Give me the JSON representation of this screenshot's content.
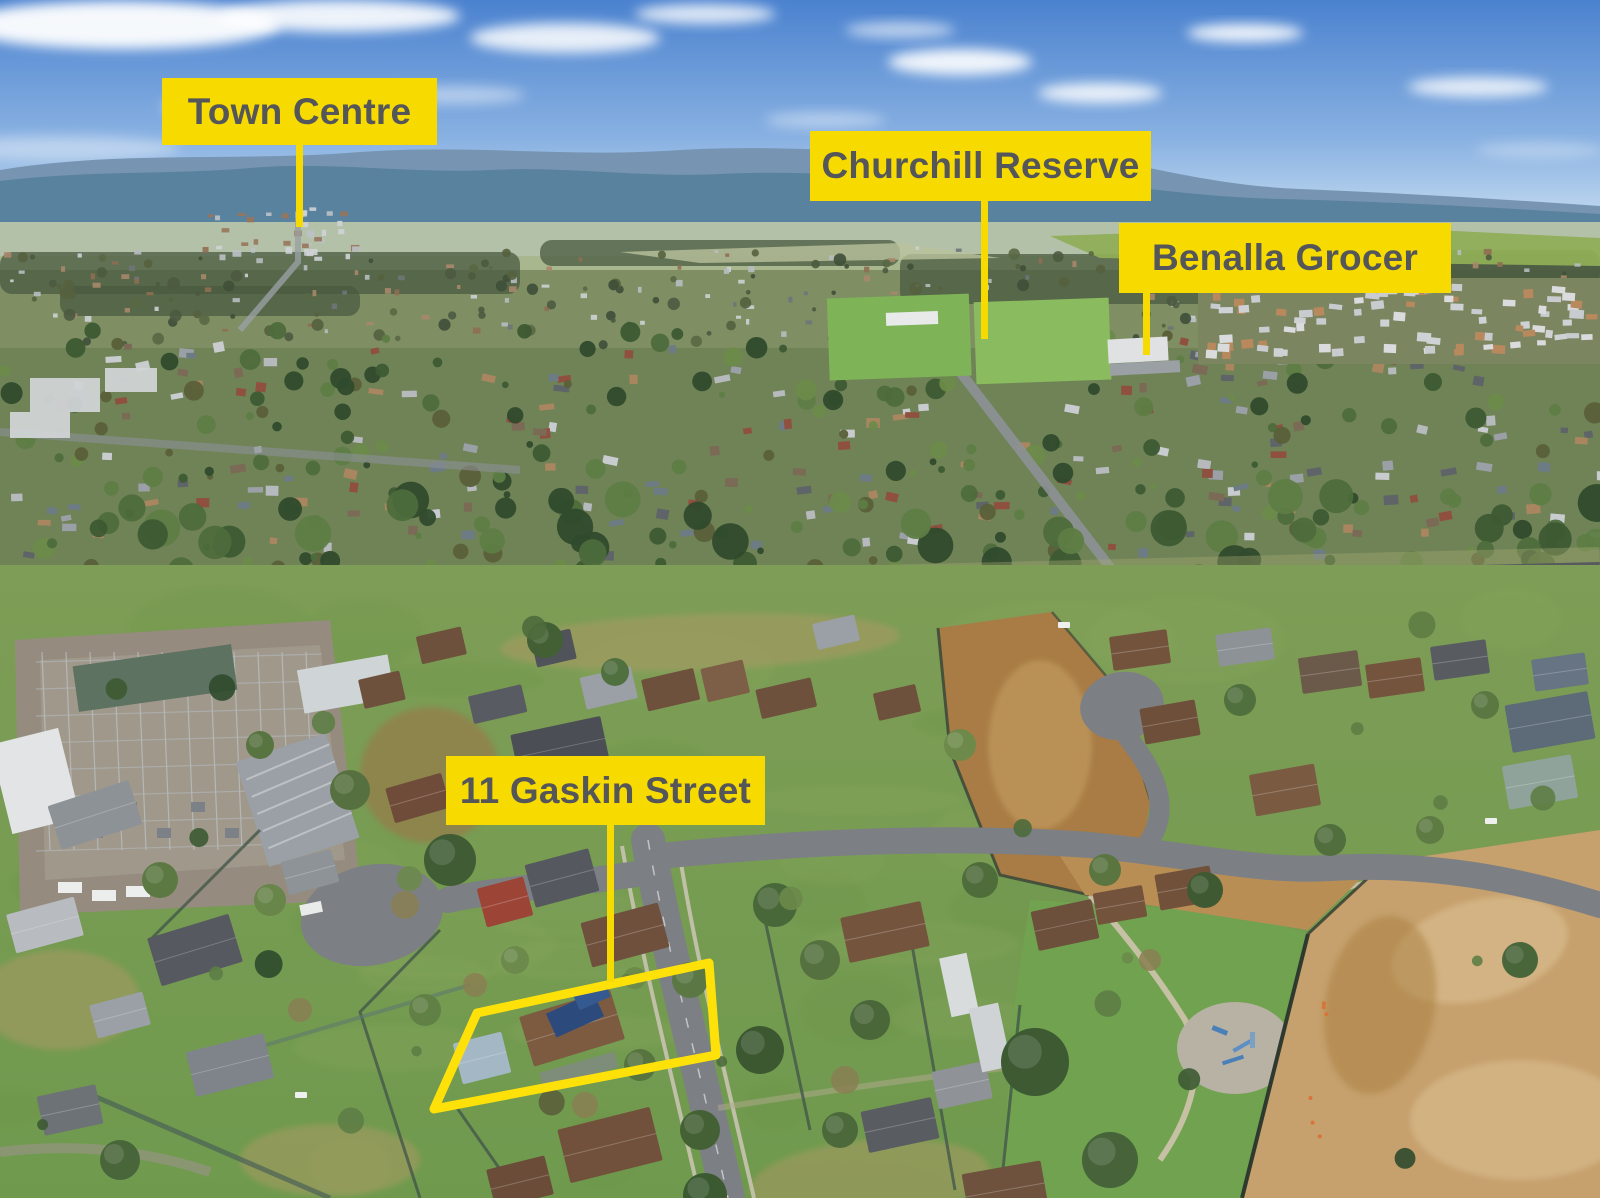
{
  "photo": {
    "alt": "Aerial drone view of a suburban town with location callouts and a highlighted property boundary",
    "callouts": [
      {
        "id": "town-centre",
        "label": "Town Centre"
      },
      {
        "id": "churchill-reserve",
        "label": "Churchill Reserve"
      },
      {
        "id": "benalla-grocer",
        "label": "Benalla Grocer"
      },
      {
        "id": "property-address",
        "label": "11 Gaskin Street"
      }
    ],
    "colors": {
      "callout_bg": "#F7DB00",
      "callout_text": "#54565A",
      "boundary_outline": "#FFE10A"
    }
  }
}
